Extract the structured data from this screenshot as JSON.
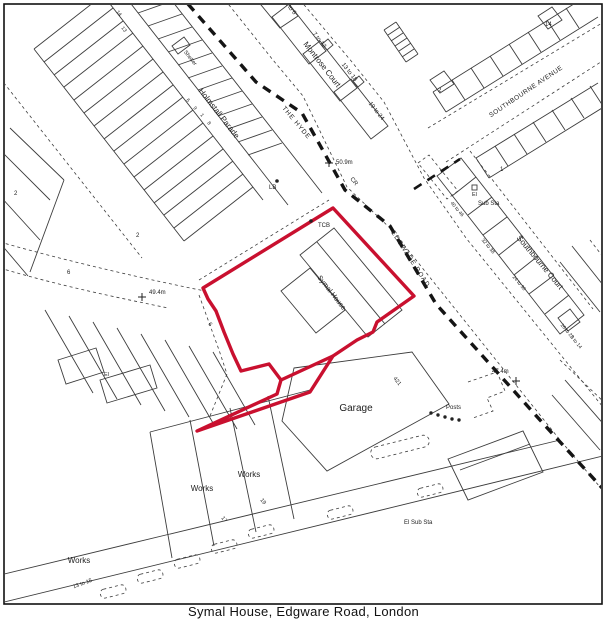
{
  "map": {
    "caption": "Symal House, Edgware Road, London",
    "colors": {
      "boundary_red": "#c9102f",
      "line": "#3d3d3d",
      "bold": "#141414"
    },
    "site_boundary": {
      "points": "333,208 414,296 377,322 373,332 357,340 333,356 310,392 252,412 197,431 277,394 281,380 269,364 241,371 233,354 224,332 216,311 208,299 203,288",
      "extra_segment": [
        281,
        380,
        333,
        356
      ]
    },
    "labels": [
      {
        "t": "Montrose Court",
        "x": 320,
        "y": 66,
        "r": 52,
        "s": 8,
        "a": "middle"
      },
      {
        "t": "1 to 6",
        "x": 289,
        "y": 9,
        "r": 52,
        "s": 6,
        "a": "middle"
      },
      {
        "t": "7 to 12",
        "x": 318,
        "y": 41,
        "r": 52,
        "s": 6,
        "a": "middle"
      },
      {
        "t": "13 to 18",
        "x": 348,
        "y": 73,
        "r": 52,
        "s": 6,
        "a": "middle"
      },
      {
        "t": "19 to 24",
        "x": 375,
        "y": 112,
        "r": 52,
        "s": 6,
        "a": "middle"
      },
      {
        "t": "THE HYDE",
        "x": 295,
        "y": 124,
        "r": 50,
        "s": 6.5,
        "a": "middle",
        "ls": 1
      },
      {
        "t": "CR",
        "x": 350,
        "y": 179,
        "r": 52,
        "s": 6
      },
      {
        "t": "50.9m",
        "x": 336,
        "y": 164,
        "r": 0,
        "s": 6
      },
      {
        "t": "LB",
        "x": 269,
        "y": 189,
        "r": 0,
        "s": 6
      },
      {
        "t": "Shelter",
        "x": 189,
        "y": 59,
        "r": 52,
        "s": 5.5,
        "a": "middle"
      },
      {
        "t": "Holmstall Parade",
        "x": 217,
        "y": 115,
        "r": 52,
        "s": 8,
        "a": "middle"
      },
      {
        "t": "14",
        "x": 116,
        "y": 12,
        "r": 52,
        "s": 5
      },
      {
        "t": "13",
        "x": 121,
        "y": 28,
        "r": 52,
        "s": 5
      },
      {
        "t": "6",
        "x": 186,
        "y": 100,
        "r": 52,
        "s": 5
      },
      {
        "t": "9",
        "x": 193,
        "y": 108,
        "r": 52,
        "s": 5
      },
      {
        "t": "1",
        "x": 200,
        "y": 115,
        "r": 52,
        "s": 5
      },
      {
        "t": "8",
        "x": 207,
        "y": 123,
        "r": 52,
        "s": 5
      },
      {
        "t": "2",
        "x": 14,
        "y": 195,
        "r": 0,
        "s": 6
      },
      {
        "t": "2",
        "x": 136,
        "y": 237,
        "r": 0,
        "s": 6
      },
      {
        "t": "6",
        "x": 67,
        "y": 274,
        "r": 0,
        "s": 6
      },
      {
        "t": "49.4m",
        "x": 149,
        "y": 294,
        "r": 0,
        "s": 6
      },
      {
        "t": "El",
        "x": 104,
        "y": 376,
        "r": 0,
        "s": 5.5
      },
      {
        "t": "6",
        "x": 208,
        "y": 324,
        "r": 52,
        "s": 5.5
      },
      {
        "t": "TCB",
        "x": 318,
        "y": 227,
        "r": 0,
        "s": 6
      },
      {
        "t": "Symal House",
        "x": 330,
        "y": 294,
        "r": 52,
        "s": 7,
        "a": "middle"
      },
      {
        "t": "SOUTHBOURNE AVENUE",
        "x": 527,
        "y": 93,
        "r": -34,
        "s": 6.5,
        "a": "middle",
        "ls": 0.5
      },
      {
        "t": "2",
        "x": 438,
        "y": 92,
        "r": 0,
        "s": 6
      },
      {
        "t": "14",
        "x": 545,
        "y": 26,
        "r": 0,
        "s": 6
      },
      {
        "t": "1",
        "x": 500,
        "y": 171,
        "r": 0,
        "s": 6
      },
      {
        "t": "El",
        "x": 472,
        "y": 196,
        "r": 0,
        "s": 5.5
      },
      {
        "t": "Sub Sta",
        "x": 478,
        "y": 205,
        "r": 0,
        "s": 6
      },
      {
        "t": "Southbourne Court",
        "x": 538,
        "y": 264,
        "r": 50,
        "s": 8,
        "a": "middle"
      },
      {
        "t": "40 to 46",
        "x": 456,
        "y": 210,
        "r": 50,
        "s": 5,
        "a": "middle"
      },
      {
        "t": "32 to 38",
        "x": 487,
        "y": 247,
        "r": 50,
        "s": 5,
        "a": "middle"
      },
      {
        "t": "24 to 30",
        "x": 518,
        "y": 284,
        "r": 50,
        "s": 5,
        "a": "middle"
      },
      {
        "t": "16 to 22",
        "x": 566,
        "y": 332,
        "r": 50,
        "s": 5,
        "a": "middle"
      },
      {
        "t": "8 to 14",
        "x": 575,
        "y": 343,
        "r": 50,
        "s": 5,
        "a": "middle"
      },
      {
        "t": "EDGWARE ROAD",
        "x": 409,
        "y": 260,
        "r": 57,
        "s": 6.5,
        "a": "middle",
        "ls": 1
      },
      {
        "t": "47.4m",
        "x": 492,
        "y": 373,
        "r": 0,
        "s": 6
      },
      {
        "t": "Garage",
        "x": 356,
        "y": 411,
        "r": 0,
        "s": 10,
        "a": "middle"
      },
      {
        "t": "Posts",
        "x": 446,
        "y": 409,
        "r": 0,
        "s": 6
      },
      {
        "t": "421",
        "x": 396,
        "y": 382,
        "r": 52,
        "s": 5.5,
        "a": "middle"
      },
      {
        "t": "Works",
        "x": 249,
        "y": 477,
        "r": 0,
        "s": 8,
        "a": "middle"
      },
      {
        "t": "Works",
        "x": 202,
        "y": 491,
        "r": 0,
        "s": 8,
        "a": "middle"
      },
      {
        "t": "Works",
        "x": 79,
        "y": 563,
        "r": 0,
        "s": 8,
        "a": "middle"
      },
      {
        "t": "17",
        "x": 221,
        "y": 518,
        "r": 52,
        "s": 5.5
      },
      {
        "t": "19",
        "x": 260,
        "y": 500,
        "r": 52,
        "s": 5.5
      },
      {
        "t": "13 to 15",
        "x": 83,
        "y": 585,
        "r": -20,
        "s": 5.5,
        "a": "middle"
      },
      {
        "t": "El Sub Sta",
        "x": 404,
        "y": 524,
        "r": 0,
        "s": 6
      }
    ],
    "markers": [
      {
        "x": 277,
        "y": 181
      },
      {
        "x": 311,
        "y": 221
      }
    ],
    "posts_dots": [
      [
        431,
        413
      ],
      [
        438,
        415
      ],
      [
        445,
        417
      ],
      [
        452,
        419
      ],
      [
        459,
        420
      ]
    ],
    "crosses": [
      [
        329,
        163
      ],
      [
        142,
        297
      ],
      [
        516,
        381
      ]
    ]
  }
}
